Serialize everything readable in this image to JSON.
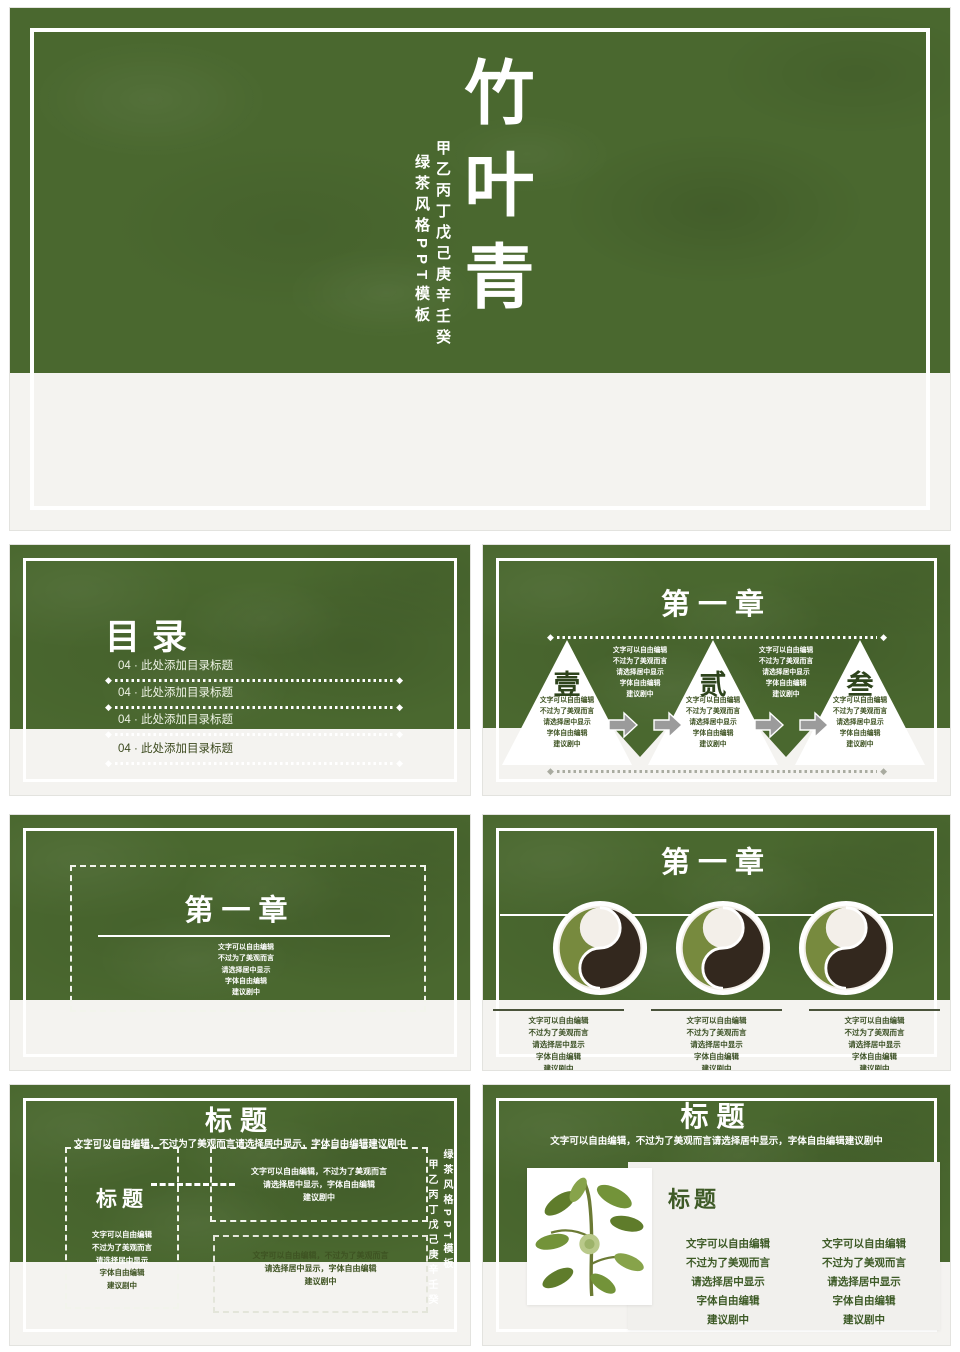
{
  "colors": {
    "slide_green": "#4a682f",
    "band_light": "#f4f3f0",
    "text_white": "#ffffff",
    "text_dark_green": "#3e5322",
    "arrow_gray": "#9b9b9b",
    "tea_dark": "#33281e",
    "tea_green": "#778a3e"
  },
  "filler": {
    "para_inline": "文字可以自由编辑，不过为了美观而言请选择居中显示，字体自由编辑建议剧中",
    "para_lines": [
      "文字可以自由编辑",
      "不过为了美观而言",
      "请选择居中显示",
      "字体自由编辑",
      "建议剧中"
    ],
    "para_3lines": [
      "文字可以自由编辑，不过为了美观而言",
      "请选择居中显示，字体自由编辑",
      "建议剧中"
    ]
  },
  "cover": {
    "title": "竹叶青",
    "subtitle_right": "甲乙丙丁戊己庚辛壬癸",
    "subtitle_left": "绿茶风格PPT模板"
  },
  "toc": {
    "title": "目录",
    "items": [
      "04 · 此处添加目录标题",
      "04 · 此处添加目录标题",
      "04 · 此处添加目录标题",
      "04 · 此处添加目录标题"
    ]
  },
  "sections": {
    "triangle": {
      "title": "第一章",
      "steps": [
        "壹",
        "贰",
        "叁"
      ]
    },
    "frame": {
      "title": "第一章"
    },
    "plates": {
      "title": "第一章"
    },
    "boxes": {
      "title": "标题",
      "box_title": "标题",
      "side_right": "绿茶风格PPT模板",
      "side_left": "甲乙丙丁戊己庚辛壬癸"
    },
    "card": {
      "title": "标题",
      "card_title": "标题"
    }
  }
}
